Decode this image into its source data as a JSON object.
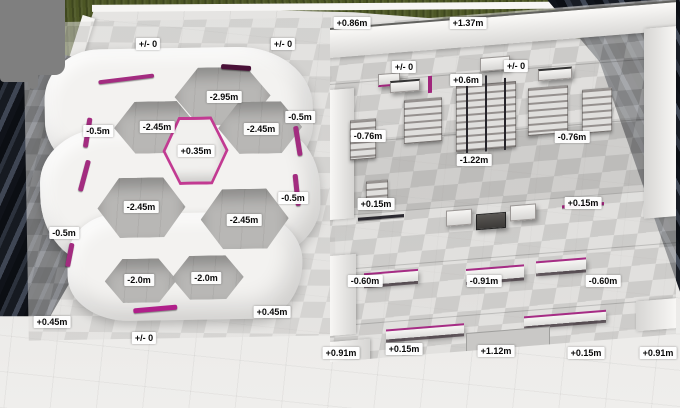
{
  "scene_title": "skatepark elevation render",
  "colors": {
    "grass": "#4c5624",
    "building_dark": "#10141b",
    "building_mid": "#3f4654",
    "concrete_light": "#e9e8e6",
    "tile_gray": "#bdbcba",
    "bowl_white": "#f3f2f0",
    "coping_magenta": "#a32c80",
    "censor_gray": "#7f7f7f",
    "label_bg": "#ffffff",
    "label_text": "#0b0b0b"
  },
  "elevation_labels": {
    "bowl_section": [
      {
        "text": "+/- 0",
        "x": 148,
        "y": 44
      },
      {
        "text": "+/- 0",
        "x": 283,
        "y": 44
      },
      {
        "text": "-2.95m",
        "x": 224,
        "y": 97
      },
      {
        "text": "-0.5m",
        "x": 98,
        "y": 131
      },
      {
        "text": "-2.45m",
        "x": 157,
        "y": 127
      },
      {
        "text": "-2.45m",
        "x": 261,
        "y": 129
      },
      {
        "text": "-0.5m",
        "x": 300,
        "y": 117
      },
      {
        "text": "+0.35m",
        "x": 196,
        "y": 151
      },
      {
        "text": "-2.45m",
        "x": 141,
        "y": 207
      },
      {
        "text": "-2.45m",
        "x": 244,
        "y": 220
      },
      {
        "text": "-0.5m",
        "x": 64,
        "y": 233
      },
      {
        "text": "-0.5m",
        "x": 293,
        "y": 198
      },
      {
        "text": "-2.0m",
        "x": 139,
        "y": 280
      },
      {
        "text": "-2.0m",
        "x": 206,
        "y": 278
      },
      {
        "text": "+0.45m",
        "x": 52,
        "y": 322
      },
      {
        "text": "+0.45m",
        "x": 272,
        "y": 312
      },
      {
        "text": "+/- 0",
        "x": 144,
        "y": 338
      }
    ],
    "street_section": [
      {
        "text": "+0.86m",
        "x": 352,
        "y": 23
      },
      {
        "text": "+1.37m",
        "x": 468,
        "y": 23
      },
      {
        "text": "+/- 0",
        "x": 404,
        "y": 67
      },
      {
        "text": "+0.6m",
        "x": 466,
        "y": 80
      },
      {
        "text": "+/- 0",
        "x": 516,
        "y": 66
      },
      {
        "text": "-0.76m",
        "x": 368,
        "y": 136
      },
      {
        "text": "-0.76m",
        "x": 572,
        "y": 137
      },
      {
        "text": "-1.22m",
        "x": 474,
        "y": 160
      },
      {
        "text": "+0.15m",
        "x": 376,
        "y": 204
      },
      {
        "text": "+0.15m",
        "x": 583,
        "y": 203
      },
      {
        "text": "-0.60m",
        "x": 365,
        "y": 281
      },
      {
        "text": "-0.91m",
        "x": 484,
        "y": 281
      },
      {
        "text": "-0.60m",
        "x": 603,
        "y": 281
      },
      {
        "text": "+0.91m",
        "x": 341,
        "y": 353
      },
      {
        "text": "+0.15m",
        "x": 404,
        "y": 349
      },
      {
        "text": "+1.12m",
        "x": 496,
        "y": 351
      },
      {
        "text": "+0.15m",
        "x": 586,
        "y": 353
      },
      {
        "text": "+0.91m",
        "x": 658,
        "y": 353
      }
    ]
  }
}
